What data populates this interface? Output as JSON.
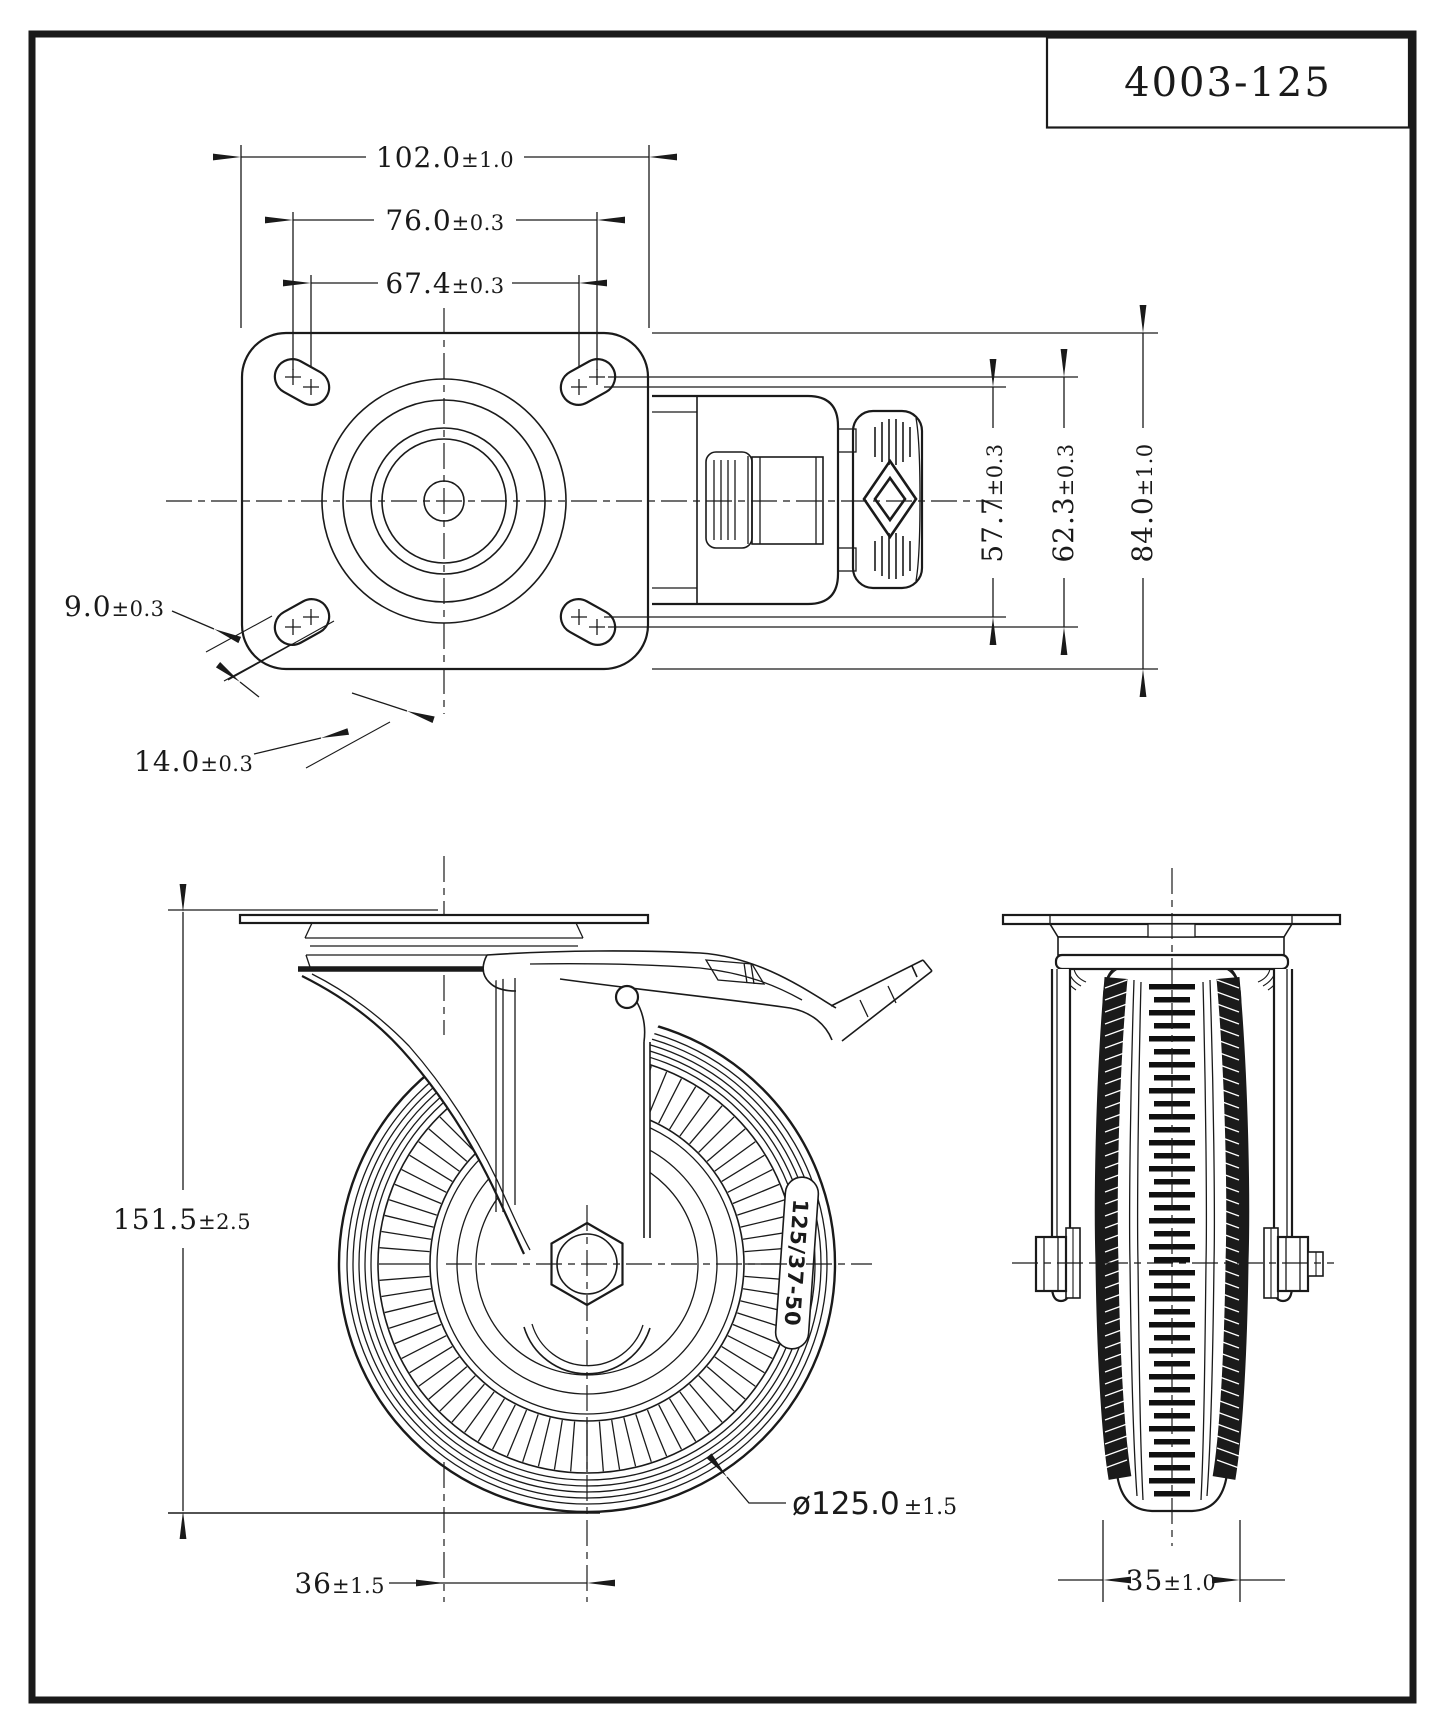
{
  "page": {
    "background": "#ffffff",
    "line_color": "#1a1a1a"
  },
  "title_block": {
    "part_number": "4003-125"
  },
  "wheel": {
    "label": "125/37-50"
  },
  "dimensions": {
    "plate_width": {
      "value": "102.0",
      "tol": "±1.0"
    },
    "hole_spacing_outer": {
      "value": "76.0",
      "tol": "±0.3"
    },
    "hole_spacing_inner": {
      "value": "67.4",
      "tol": "±0.3"
    },
    "slot_width": {
      "value": "9.0",
      "tol": "±0.3"
    },
    "slot_length": {
      "value": "14.0",
      "tol": "±0.3"
    },
    "hole_spacing_vert_inner": {
      "value": "57.7",
      "tol": "±0.3"
    },
    "hole_spacing_vert_outer": {
      "value": "62.3",
      "tol": "±0.3"
    },
    "plate_depth": {
      "value": "84.0",
      "tol": "±1.0"
    },
    "overall_height": {
      "value": "151.5",
      "tol": "±2.5"
    },
    "swivel_offset": {
      "value": "36",
      "tol": "±1.5"
    },
    "wheel_diameter": {
      "value": "ø125.0",
      "tol": "±1.5"
    },
    "wheel_width": {
      "value": "35",
      "tol": "±1.0"
    }
  }
}
